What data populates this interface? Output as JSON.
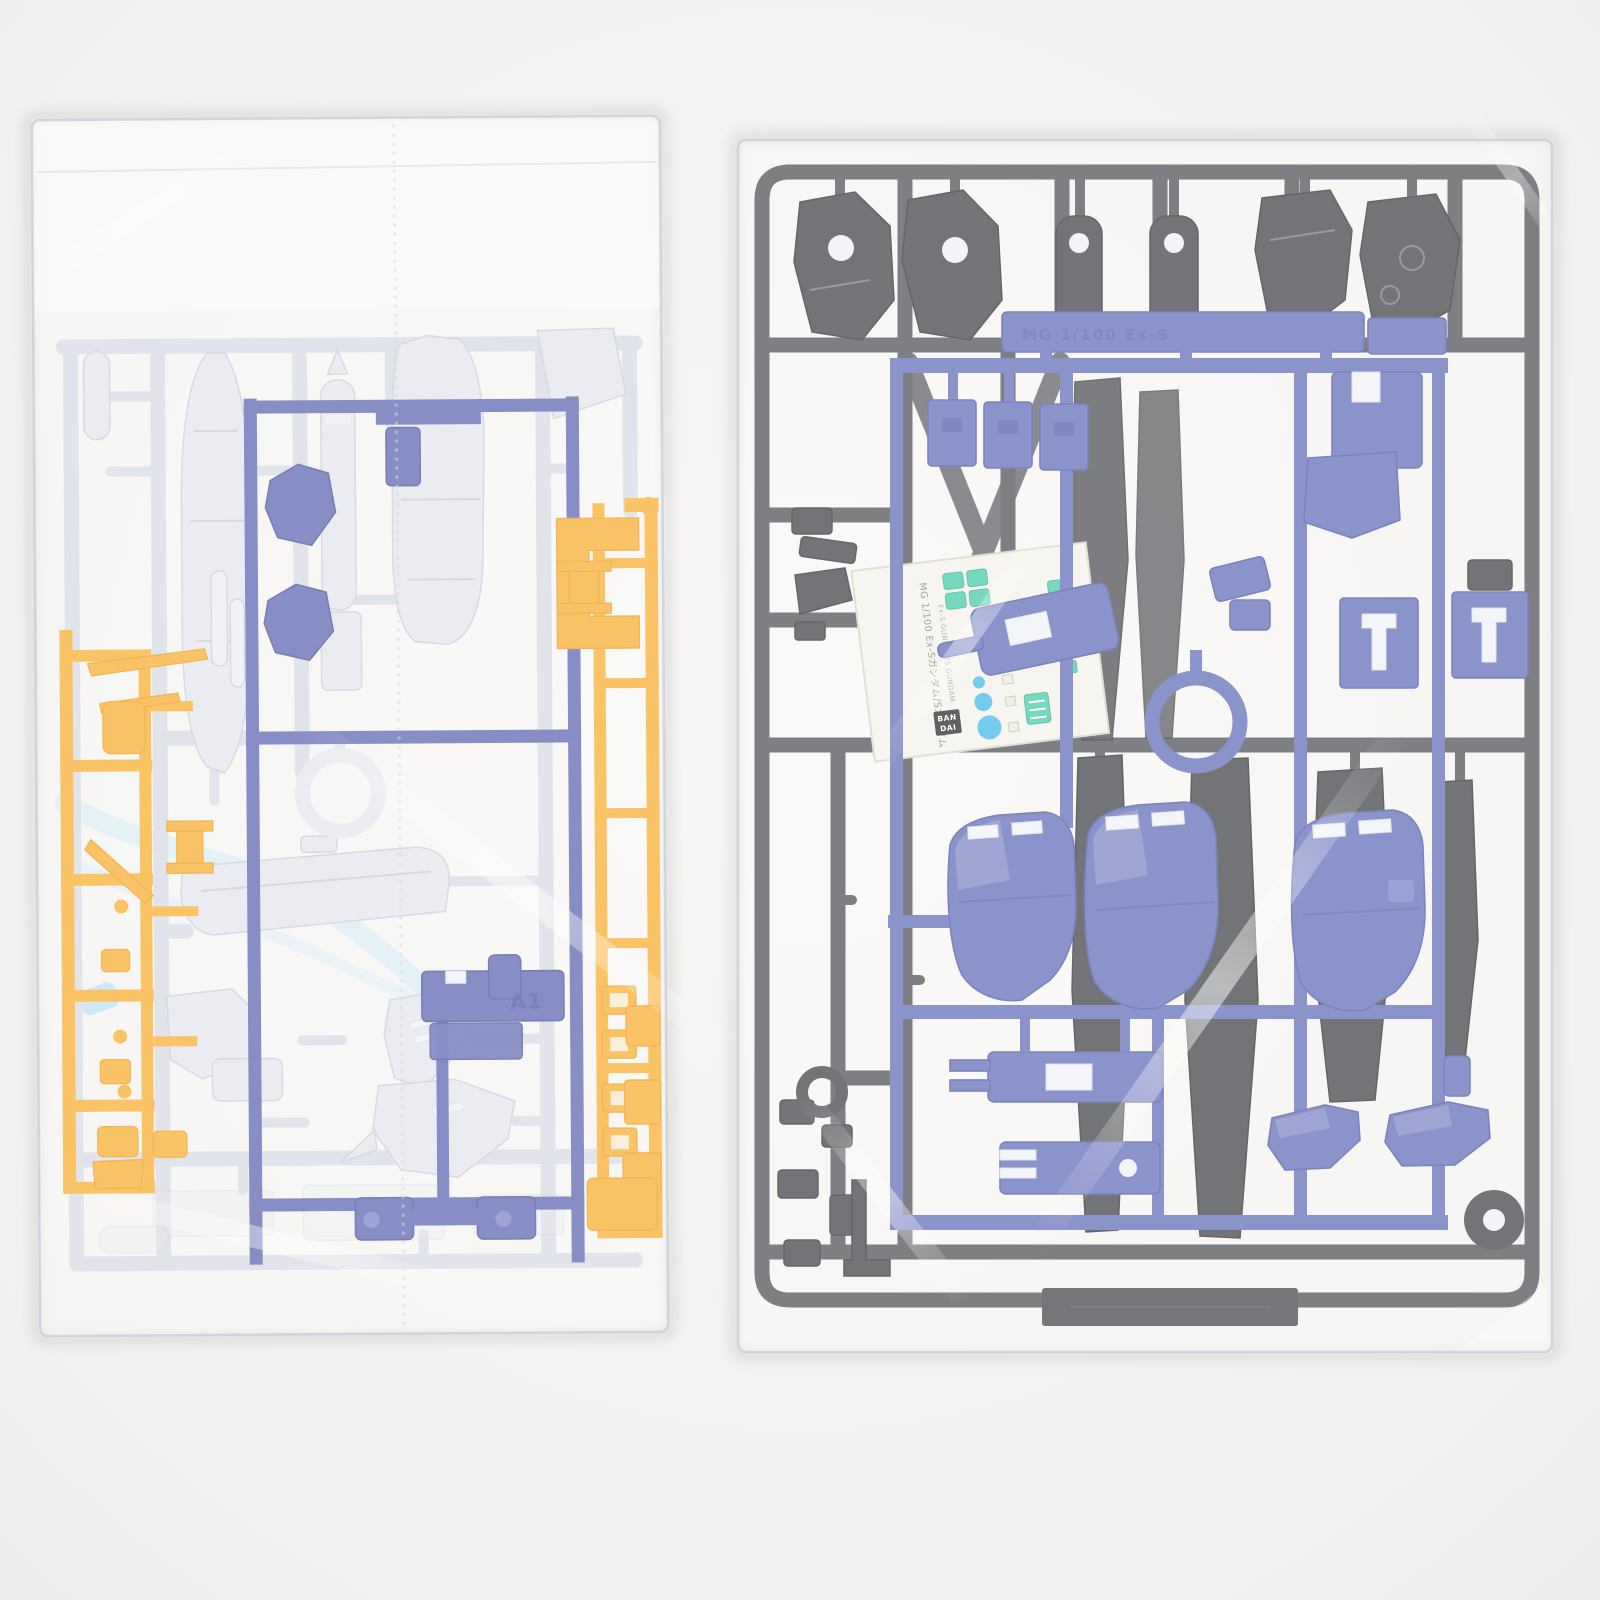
{
  "scene": {
    "background": "#f2f1ef",
    "alt": "Two factory-sealed clear plastic bags containing injection-molded model kit runners (sprues): left bag with light gray, blue, orange and clear-blue runners; right bag with dark gray and blue runners plus a marking sticker sheet"
  },
  "colors": {
    "background": "#f2f1ef",
    "gray_rail": "#d3d7e0",
    "gray_part": "#e0e3ea",
    "blue_left": "#4e59aa",
    "orange": "#f8a71d",
    "clear_blue": "#b5dff2",
    "dark_rail": "#45484e",
    "dark_part": "#36383d",
    "blue_right": "#5a65b5",
    "sticker_paper": "#f2f1e8",
    "teal": "#3cc8a4",
    "cyan": "#38b5e7",
    "logo_black": "#1d1d1f"
  },
  "left_bag": {
    "blue_runner": {
      "tag": "A1"
    }
  },
  "right_bag": {
    "blue_runner": {
      "embossed": "MG 1/100 Ex-S"
    },
    "sticker": {
      "brand_top": "BAN",
      "brand_bottom": "DAI",
      "title_jp": "MG 1/100 Ex-Sガンダム/Sガンダム",
      "title_en": "Ex-S GUNDAM/S GUNDAM"
    }
  }
}
